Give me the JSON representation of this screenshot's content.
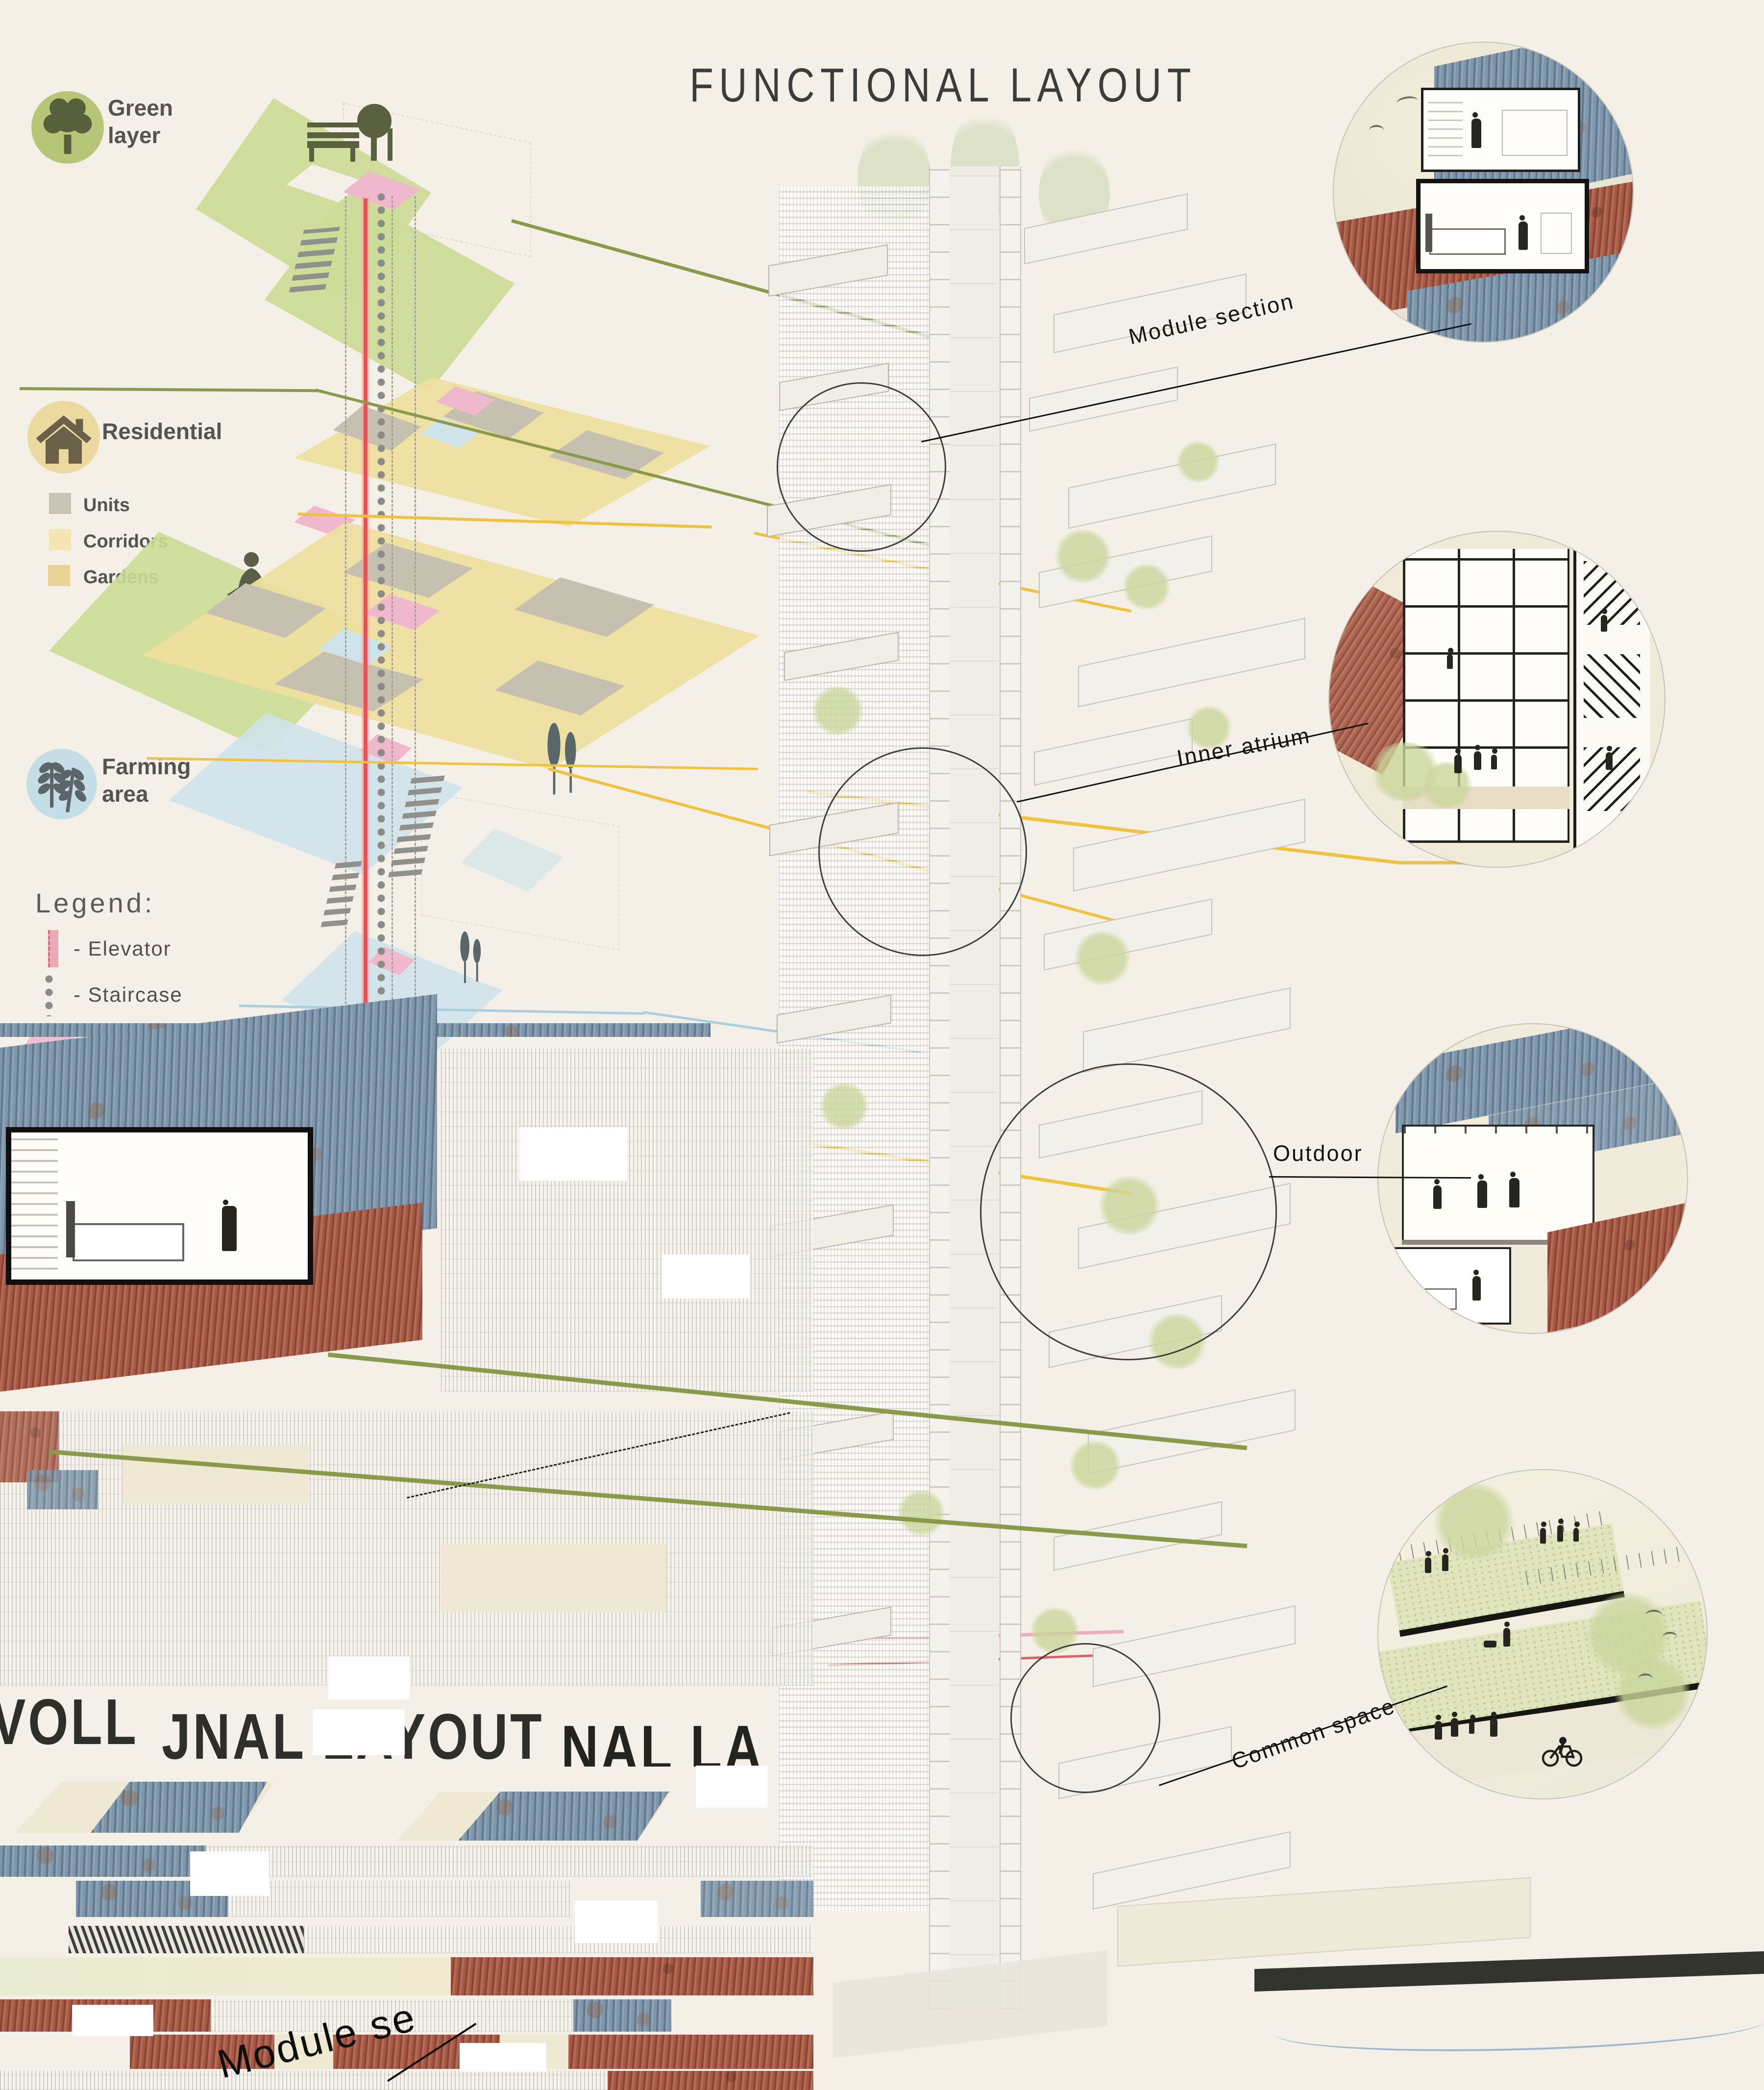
{
  "title": "FUNCTIONAL LAYOUT",
  "legend_panel": {
    "categories": [
      {
        "label": "Green layer",
        "icon": "tree-icon",
        "circle_color": "#b6c578"
      },
      {
        "label": "Residential",
        "icon": "house-icon",
        "circle_color": "#ecd9a0",
        "sub_items": [
          {
            "label": "Units",
            "swatch_color": "#c9c3b3"
          },
          {
            "label": "Corridors",
            "swatch_color": "#f4e6b2"
          },
          {
            "label": "Gardens",
            "swatch_color": "#e8d395"
          }
        ]
      },
      {
        "label": "Farming area",
        "icon": "wheat-icon",
        "circle_color": "#c5dde6"
      }
    ],
    "legend_heading": "Legend:",
    "legend_items": [
      {
        "label": "- Elevator",
        "marker": "elevator-bar",
        "color": "#e59aa8"
      },
      {
        "label": "- Staircase",
        "marker": "dot-column",
        "color": "#8a8a88"
      },
      {
        "label": "- Vertical connections",
        "marker": "pink-parallelogram",
        "color": "#eec0d0"
      }
    ]
  },
  "callouts": [
    {
      "label": "Module section"
    },
    {
      "label": "Inner atrium"
    },
    {
      "label": "Outdoor"
    },
    {
      "label": "Common space"
    }
  ],
  "glitch_fragments": {
    "title_piece_left": "VOLL",
    "title_piece_mid": "JNAL LAYOUT",
    "title_piece_right": "NAL LA",
    "module_label_piece": "Module se"
  },
  "palette": {
    "background": "#f5f0e7",
    "green_layer": "#ccdc96",
    "residential_yellow": "#eedf9f",
    "units_gray": "#c9c3b3",
    "farming_blue": "#cfe3ea",
    "elevator_red": "#e05858",
    "connection_pink": "#f0b8cc",
    "leader_olive": "#8a9a4b",
    "leader_yellow": "#f0c23e",
    "leader_blue": "#a8cfe0",
    "container_blue": "#6d88a3",
    "container_red": "#a05240"
  }
}
